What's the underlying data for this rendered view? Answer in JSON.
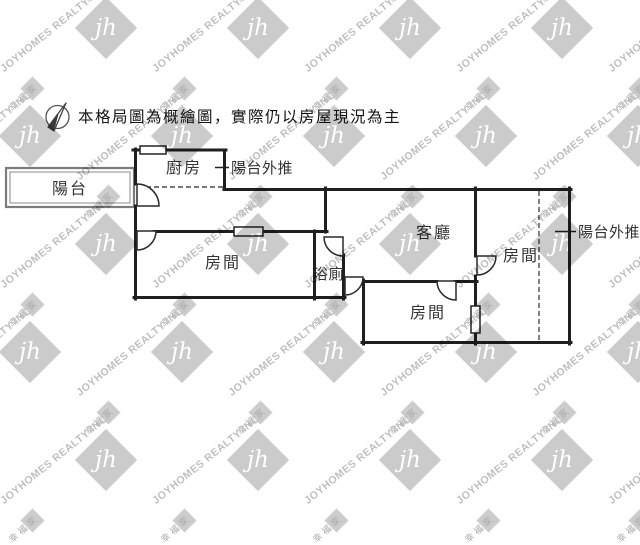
{
  "disclaimer": {
    "text": "本格局圖為概繪圖，實際仍以房屋現況為主"
  },
  "watermark": {
    "company": "JOYHOMES REALTY INC.",
    "logo_monogram": "jh",
    "brand_name": "幸福家"
  },
  "labels": {
    "balcony": "陽台",
    "kitchen": "廚房",
    "balcony_pushout_top": "陽台外推",
    "room_left": "房間",
    "bathroom": "浴廁",
    "living_room": "客廳",
    "room_right": "房間",
    "room_bottom": "房間",
    "balcony_pushout_right": "陽台外推"
  },
  "colors": {
    "wall": "#1f1f1f",
    "balcony_outline": "#7c7c7c",
    "label_text": "#333333",
    "dashed_line": "#4a4a4a",
    "watermark_gray": "#c9c9c9"
  }
}
